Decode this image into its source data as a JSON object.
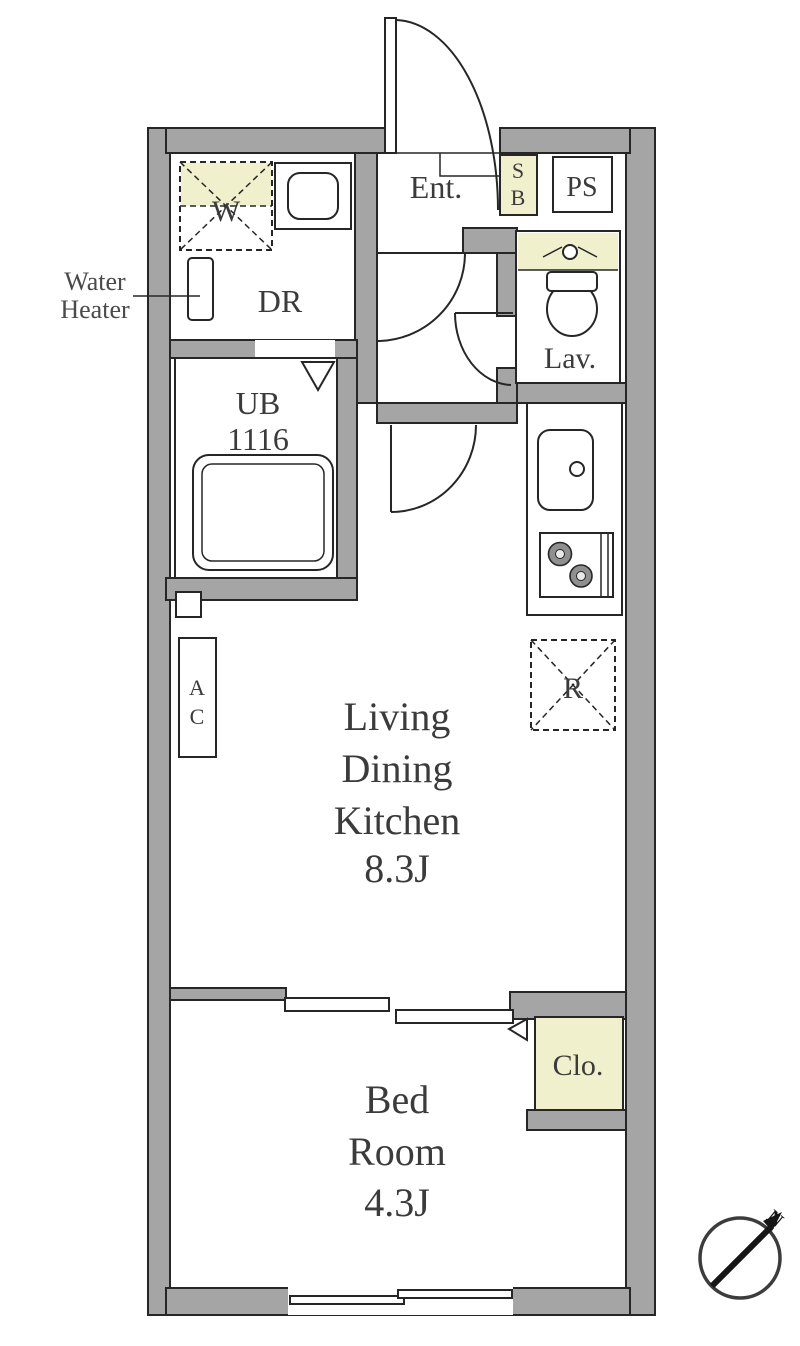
{
  "colors": {
    "wall_fill": "#a5a5a5",
    "outline": "#262626",
    "highlight_yellow": "#f1f0cd",
    "label_text": "#3b3b3b"
  },
  "plan": {
    "entrance": {
      "label": "Ent."
    },
    "shoe_box": {
      "line1": "S",
      "line2": "B"
    },
    "pipe_space": {
      "label": "PS"
    },
    "washing_machine": {
      "label": "W"
    },
    "dressing_room": {
      "label": "DR"
    },
    "water_heater_note": {
      "line1": "Water",
      "line2": "Heater"
    },
    "unit_bath": {
      "line1": "UB",
      "line2": "1116"
    },
    "lavatory": {
      "label": "Lav."
    },
    "air_conditioner": {
      "line1": "A",
      "line2": "C"
    },
    "refrigerator": {
      "label": "R"
    },
    "living_dining_kitchen": {
      "line1": "Living",
      "line2": "Dining",
      "line3": "Kitchen",
      "size": "8.3J"
    },
    "bed_room": {
      "line1": "Bed",
      "line2": "Room",
      "size": "4.3J"
    },
    "closet": {
      "label": "Clo."
    },
    "compass": {
      "north": "N"
    }
  }
}
